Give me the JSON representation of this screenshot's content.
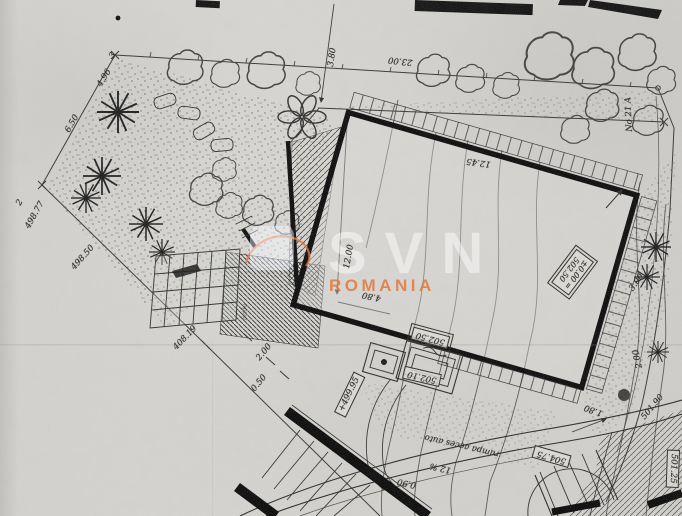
{
  "watermark": {
    "brand": "SVN",
    "region": "ROMANIA"
  },
  "colors": {
    "watermark_orange": "#e0793f",
    "ink": "#2f2f2d",
    "paper": "#d7d6d2"
  },
  "street": {
    "number_label": "No 21 A"
  },
  "points": {
    "p2": "2",
    "p2_elev": "498.77",
    "p3": "3"
  },
  "dimensions": {
    "offset_north": "3.80",
    "frontage": "23.00",
    "seg_496": "4.96",
    "seg_650": "6.50",
    "yard": "12.00",
    "terrace": "4.80",
    "interior": "12.45",
    "d180": "1.80",
    "d200_sw": "2.00",
    "d050": "0.50",
    "d200_e": "2.00",
    "d300": "3.00",
    "d090": "0.90"
  },
  "elevations": {
    "b1": "498.50",
    "b2": "408.19",
    "level_line1": "±0.00 =",
    "level_line2": "502.50",
    "e49995": "+499.95",
    "e50250": "502.50",
    "e50210": "502.10",
    "e50475": "504.75",
    "e50125": "501.25",
    "e50190": "501.90"
  },
  "ramp": {
    "label": "rampa acces auto",
    "slope": "12 %"
  },
  "annotations": {
    "niche": "firida"
  }
}
